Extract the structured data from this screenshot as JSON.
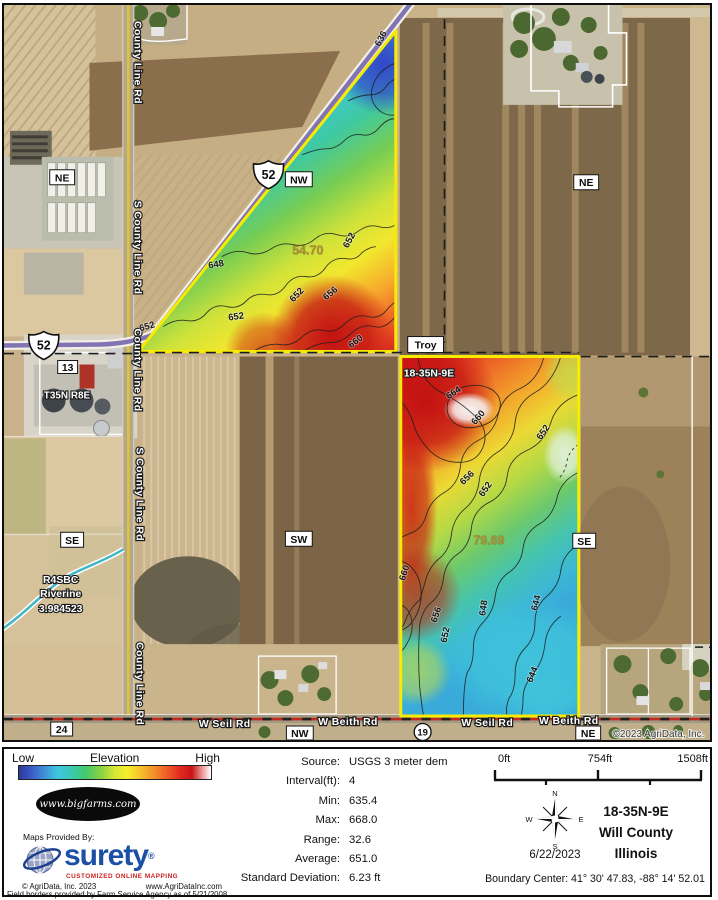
{
  "map": {
    "roads": [
      "County Line Rd",
      "S County Line Rd",
      "County Line Rd",
      "S County Line Rd",
      "County Line Rd",
      "W Seil Rd",
      "W Beith Rd",
      "W Seil Rd",
      "W Beith Rd"
    ],
    "boxes": [
      "NE",
      "NW",
      "NE",
      "Troy",
      "SW",
      "SE",
      "SE",
      "NW",
      "NE",
      "24",
      "13"
    ],
    "halos": [
      "T35N R8E",
      "18-35N-9E",
      "R4SBC",
      "Riverine",
      "3.984523"
    ],
    "shield52": "52",
    "shield19": "19",
    "parcels": [
      "54.70",
      "79.69"
    ],
    "contours_triangle": [
      "636",
      "648",
      "652",
      "652",
      "652",
      "652",
      "656",
      "660"
    ],
    "contours_east": [
      "664",
      "660",
      "652",
      "656",
      "652",
      "660",
      "656",
      "652",
      "648",
      "644",
      "644"
    ],
    "copyright": "©2023 AgriData, Inc."
  },
  "legend": {
    "low": "Low",
    "title": "Elevation",
    "high": "High",
    "bigfarms": "www.bigfarms.com",
    "provided_by": "Maps Provided By:",
    "surety": "surety",
    "surety_reg": "®",
    "surety_tagline": "CUSTOMIZED ONLINE MAPPING",
    "agridata_copy": "© AgriData, Inc. 2023",
    "agridata_url": "www.AgriDataInc.com",
    "fsa_note": "Field borders provided by Farm Service Agency as of 5/21/2008."
  },
  "stats": {
    "rows": [
      {
        "label": "Source:",
        "value": "USGS 3 meter dem"
      },
      {
        "label": "Interval(ft):",
        "value": "4"
      },
      {
        "label": "Min:",
        "value": "635.4"
      },
      {
        "label": "Max:",
        "value": "668.0"
      },
      {
        "label": "Range:",
        "value": "32.6"
      },
      {
        "label": "Average:",
        "value": "651.0"
      },
      {
        "label": "Standard Deviation:",
        "value": "6.23 ft"
      }
    ]
  },
  "scalebar": {
    "t0": "0ft",
    "t1": "754ft",
    "t2": "1508ft"
  },
  "compass": {
    "n": "N",
    "e": "E",
    "s": "S",
    "w": "W",
    "date": "6/22/2023"
  },
  "location": {
    "section": "18-35N-9E",
    "county": "Will County",
    "state": "Illinois",
    "boundary_center": "Boundary Center: 41° 30' 47.83,  -88° 14' 52.01"
  }
}
